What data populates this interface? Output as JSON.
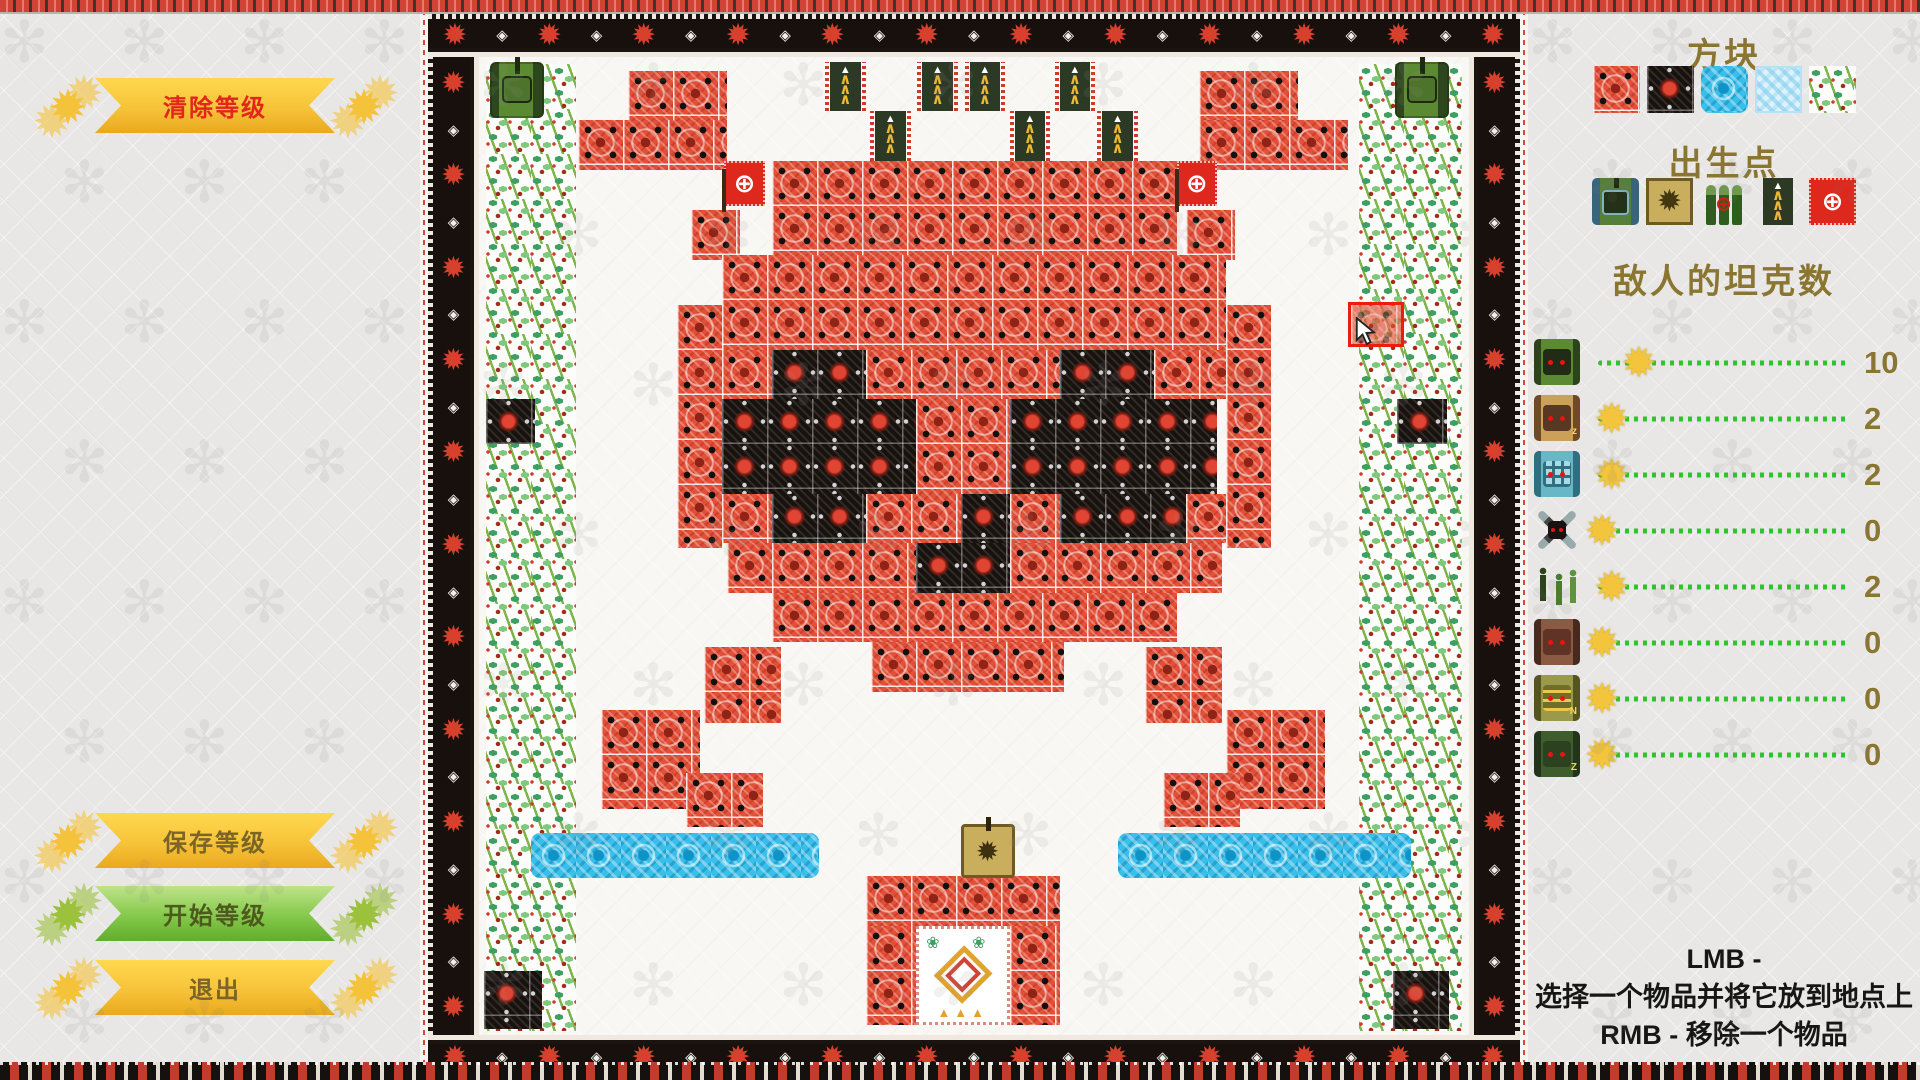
{
  "left_panel": {
    "clear_button": "清除等级",
    "save_button": "保存等级",
    "start_button": "开始等级",
    "exit_button": "退出"
  },
  "right_panel": {
    "blocks_title": "方块",
    "blocks": [
      {
        "id": "brick",
        "name": "brick-block"
      },
      {
        "id": "stone",
        "name": "stone-block"
      },
      {
        "id": "water",
        "name": "water-block"
      },
      {
        "id": "ice",
        "name": "ice-block"
      },
      {
        "id": "trees",
        "name": "trees-block"
      }
    ],
    "spawns_title": "出生点",
    "spawns": [
      {
        "id": "player-tank",
        "name": "player-tank-spawn"
      },
      {
        "id": "gold-tank",
        "name": "base-tank-spawn"
      },
      {
        "id": "ammo",
        "name": "ammo-spawn"
      },
      {
        "id": "enemy-banner",
        "name": "enemy-banner-spawn"
      },
      {
        "id": "red-flag",
        "name": "red-flag-spawn"
      }
    ],
    "enemies_title": "敌人的坦克数",
    "enemy_rows": [
      {
        "icon": "tank-basic",
        "mark": "",
        "count": 10,
        "handle_frac": 0.15
      },
      {
        "icon": "tank-cat",
        "mark": "z",
        "count": 2,
        "handle_frac": 0.05
      },
      {
        "icon": "tank-blue",
        "mark": "",
        "count": 2,
        "handle_frac": 0.05
      },
      {
        "icon": "drone",
        "mark": "",
        "count": 0,
        "handle_frac": 0.015
      },
      {
        "icon": "infantry",
        "mark": "",
        "count": 2,
        "handle_frac": 0.05
      },
      {
        "icon": "tank-bear",
        "mark": "",
        "count": 0,
        "handle_frac": 0.015
      },
      {
        "icon": "tank-olive",
        "mark": "N",
        "count": 0,
        "handle_frac": 0.015
      },
      {
        "icon": "tank-green-z",
        "mark": "Z",
        "count": 0,
        "handle_frac": 0.015
      }
    ],
    "help_line1": "LMB -",
    "help_line2": "选择一个物品并将它放到地点上",
    "help_line3": "RMB - 移除一个物品"
  },
  "colors": {
    "accent_yellow": "#f5c33b",
    "accent_green": "#76b82a",
    "brick_red": "#e44f37",
    "stone_black": "#18120f",
    "water_blue": "#38bfec",
    "ice_blue": "#ddf2fb",
    "title_olive": "#8a7631",
    "clear_text_red": "#e3261d",
    "slider_green": "#2fc42f"
  },
  "map": {
    "cols": 22,
    "rows": 21.7,
    "tile": 45,
    "tiles": [
      {
        "t": "trees",
        "x": 0.15,
        "y": 0.15,
        "w": 2.0,
        "h": 21.5
      },
      {
        "t": "trees",
        "x": 19.55,
        "y": 0.15,
        "w": 2.3,
        "h": 21.5
      },
      {
        "t": "water",
        "x": 1.15,
        "y": 17.25,
        "w": 6.4,
        "h": 1.0
      },
      {
        "t": "water",
        "x": 14.2,
        "y": 17.25,
        "w": 6.5,
        "h": 1.0
      },
      {
        "t": "brick",
        "x": 3.3,
        "y": 0.3,
        "w": 2.2,
        "h": 1.1
      },
      {
        "t": "brick",
        "x": 2.2,
        "y": 1.4,
        "w": 3.3,
        "h": 1.1
      },
      {
        "t": "brick",
        "x": 4.7,
        "y": 3.4,
        "w": 1.1,
        "h": 1.1
      },
      {
        "t": "brick",
        "x": 16.0,
        "y": 0.3,
        "w": 2.2,
        "h": 1.1
      },
      {
        "t": "brick",
        "x": 16.0,
        "y": 1.4,
        "w": 3.3,
        "h": 1.1
      },
      {
        "t": "brick",
        "x": 15.7,
        "y": 3.4,
        "w": 1.1,
        "h": 1.1
      },
      {
        "t": "brick",
        "x": 6.5,
        "y": 2.3,
        "w": 9.0,
        "h": 2.1
      },
      {
        "t": "brick",
        "x": 5.4,
        "y": 4.4,
        "w": 11.2,
        "h": 2.1
      },
      {
        "t": "brick",
        "x": 4.4,
        "y": 5.5,
        "w": 1.0,
        "h": 5.4
      },
      {
        "t": "brick",
        "x": 16.6,
        "y": 5.5,
        "w": 1.0,
        "h": 5.4
      },
      {
        "t": "brick",
        "x": 5.4,
        "y": 6.5,
        "w": 1.1,
        "h": 1.1
      },
      {
        "t": "brick",
        "x": 8.6,
        "y": 6.5,
        "w": 4.3,
        "h": 1.1
      },
      {
        "t": "brick",
        "x": 15.0,
        "y": 6.5,
        "w": 1.6,
        "h": 1.1
      },
      {
        "t": "brick",
        "x": 9.7,
        "y": 7.6,
        "w": 2.1,
        "h": 2.1
      },
      {
        "t": "brick",
        "x": 5.4,
        "y": 9.7,
        "w": 1.1,
        "h": 1.1
      },
      {
        "t": "brick",
        "x": 8.6,
        "y": 9.7,
        "w": 2.1,
        "h": 1.1
      },
      {
        "t": "brick",
        "x": 11.8,
        "y": 9.7,
        "w": 1.1,
        "h": 1.1
      },
      {
        "t": "brick",
        "x": 15.7,
        "y": 9.7,
        "w": 0.9,
        "h": 1.1
      },
      {
        "t": "brick",
        "x": 5.5,
        "y": 10.8,
        "w": 4.2,
        "h": 1.1
      },
      {
        "t": "brick",
        "x": 11.8,
        "y": 10.8,
        "w": 4.7,
        "h": 1.1
      },
      {
        "t": "brick",
        "x": 6.5,
        "y": 11.9,
        "w": 9.0,
        "h": 1.1
      },
      {
        "t": "brick",
        "x": 8.7,
        "y": 13.0,
        "w": 4.3,
        "h": 1.1
      },
      {
        "t": "brick",
        "x": 5.0,
        "y": 13.1,
        "w": 1.7,
        "h": 1.7
      },
      {
        "t": "brick",
        "x": 14.8,
        "y": 13.1,
        "w": 1.7,
        "h": 1.7
      },
      {
        "t": "brick",
        "x": 2.7,
        "y": 14.5,
        "w": 2.2,
        "h": 2.2
      },
      {
        "t": "brick",
        "x": 16.6,
        "y": 14.5,
        "w": 2.2,
        "h": 2.2
      },
      {
        "t": "brick",
        "x": 4.6,
        "y": 15.9,
        "w": 1.7,
        "h": 1.2
      },
      {
        "t": "brick",
        "x": 15.2,
        "y": 15.9,
        "w": 1.7,
        "h": 1.2
      },
      {
        "t": "brick",
        "x": 8.6,
        "y": 18.2,
        "w": 4.3,
        "h": 1.1
      },
      {
        "t": "brick",
        "x": 8.6,
        "y": 19.3,
        "w": 1.1,
        "h": 2.2
      },
      {
        "t": "brick",
        "x": 11.8,
        "y": 19.3,
        "w": 1.1,
        "h": 2.2
      },
      {
        "t": "stone",
        "x": 6.5,
        "y": 6.5,
        "w": 2.1,
        "h": 1.1
      },
      {
        "t": "stone",
        "x": 12.9,
        "y": 6.5,
        "w": 2.1,
        "h": 1.1
      },
      {
        "t": "stone",
        "x": 5.4,
        "y": 7.6,
        "w": 4.3,
        "h": 2.1
      },
      {
        "t": "stone",
        "x": 11.8,
        "y": 7.6,
        "w": 4.6,
        "h": 2.1
      },
      {
        "t": "stone",
        "x": 6.5,
        "y": 9.7,
        "w": 2.1,
        "h": 1.1
      },
      {
        "t": "stone",
        "x": 12.9,
        "y": 9.7,
        "w": 2.8,
        "h": 1.1
      },
      {
        "t": "stone",
        "x": 10.7,
        "y": 9.7,
        "w": 1.1,
        "h": 1.1
      },
      {
        "t": "stone",
        "x": 9.7,
        "y": 10.8,
        "w": 2.1,
        "h": 1.1
      },
      {
        "t": "stone",
        "x": 0.15,
        "y": 7.6,
        "w": 1.1,
        "h": 1.0
      },
      {
        "t": "stone",
        "x": 20.4,
        "y": 7.6,
        "w": 1.1,
        "h": 1.0
      },
      {
        "t": "stone",
        "x": 0.1,
        "y": 20.3,
        "w": 1.3,
        "h": 1.3
      },
      {
        "t": "stone",
        "x": 20.3,
        "y": 20.3,
        "w": 1.25,
        "h": 1.3
      },
      {
        "t": "banner",
        "x": 7.8,
        "y": 0.1,
        "w": 0.68,
        "h": 1.1
      },
      {
        "t": "banner",
        "x": 8.8,
        "y": 1.2,
        "w": 0.68,
        "h": 1.1
      },
      {
        "t": "banner",
        "x": 9.85,
        "y": 0.1,
        "w": 0.68,
        "h": 1.1
      },
      {
        "t": "banner",
        "x": 10.9,
        "y": 0.1,
        "w": 0.68,
        "h": 1.1
      },
      {
        "t": "banner",
        "x": 11.9,
        "y": 1.2,
        "w": 0.68,
        "h": 1.1
      },
      {
        "t": "banner",
        "x": 12.9,
        "y": 0.1,
        "w": 0.68,
        "h": 1.1
      },
      {
        "t": "banner",
        "x": 13.85,
        "y": 1.2,
        "w": 0.68,
        "h": 1.1
      },
      {
        "t": "flag",
        "x": 5.45,
        "y": 2.3,
        "w": 0.9,
        "h": 1.0
      },
      {
        "t": "flag",
        "x": 15.5,
        "y": 2.3,
        "w": 0.9,
        "h": 1.0
      },
      {
        "t": "tank",
        "x": 0.25,
        "y": 0.1,
        "w": 1.2,
        "h": 1.25
      },
      {
        "t": "tank",
        "x": 20.35,
        "y": 0.1,
        "w": 1.2,
        "h": 1.25
      },
      {
        "t": "goldtank",
        "x": 10.7,
        "y": 17.05,
        "w": 1.2,
        "h": 1.2
      },
      {
        "t": "emblem",
        "x": 9.7,
        "y": 19.3,
        "w": 2.1,
        "h": 2.2
      }
    ],
    "cursor": {
      "x": 19.3,
      "y": 5.45,
      "w": 1.25,
      "h": 1.0
    }
  }
}
